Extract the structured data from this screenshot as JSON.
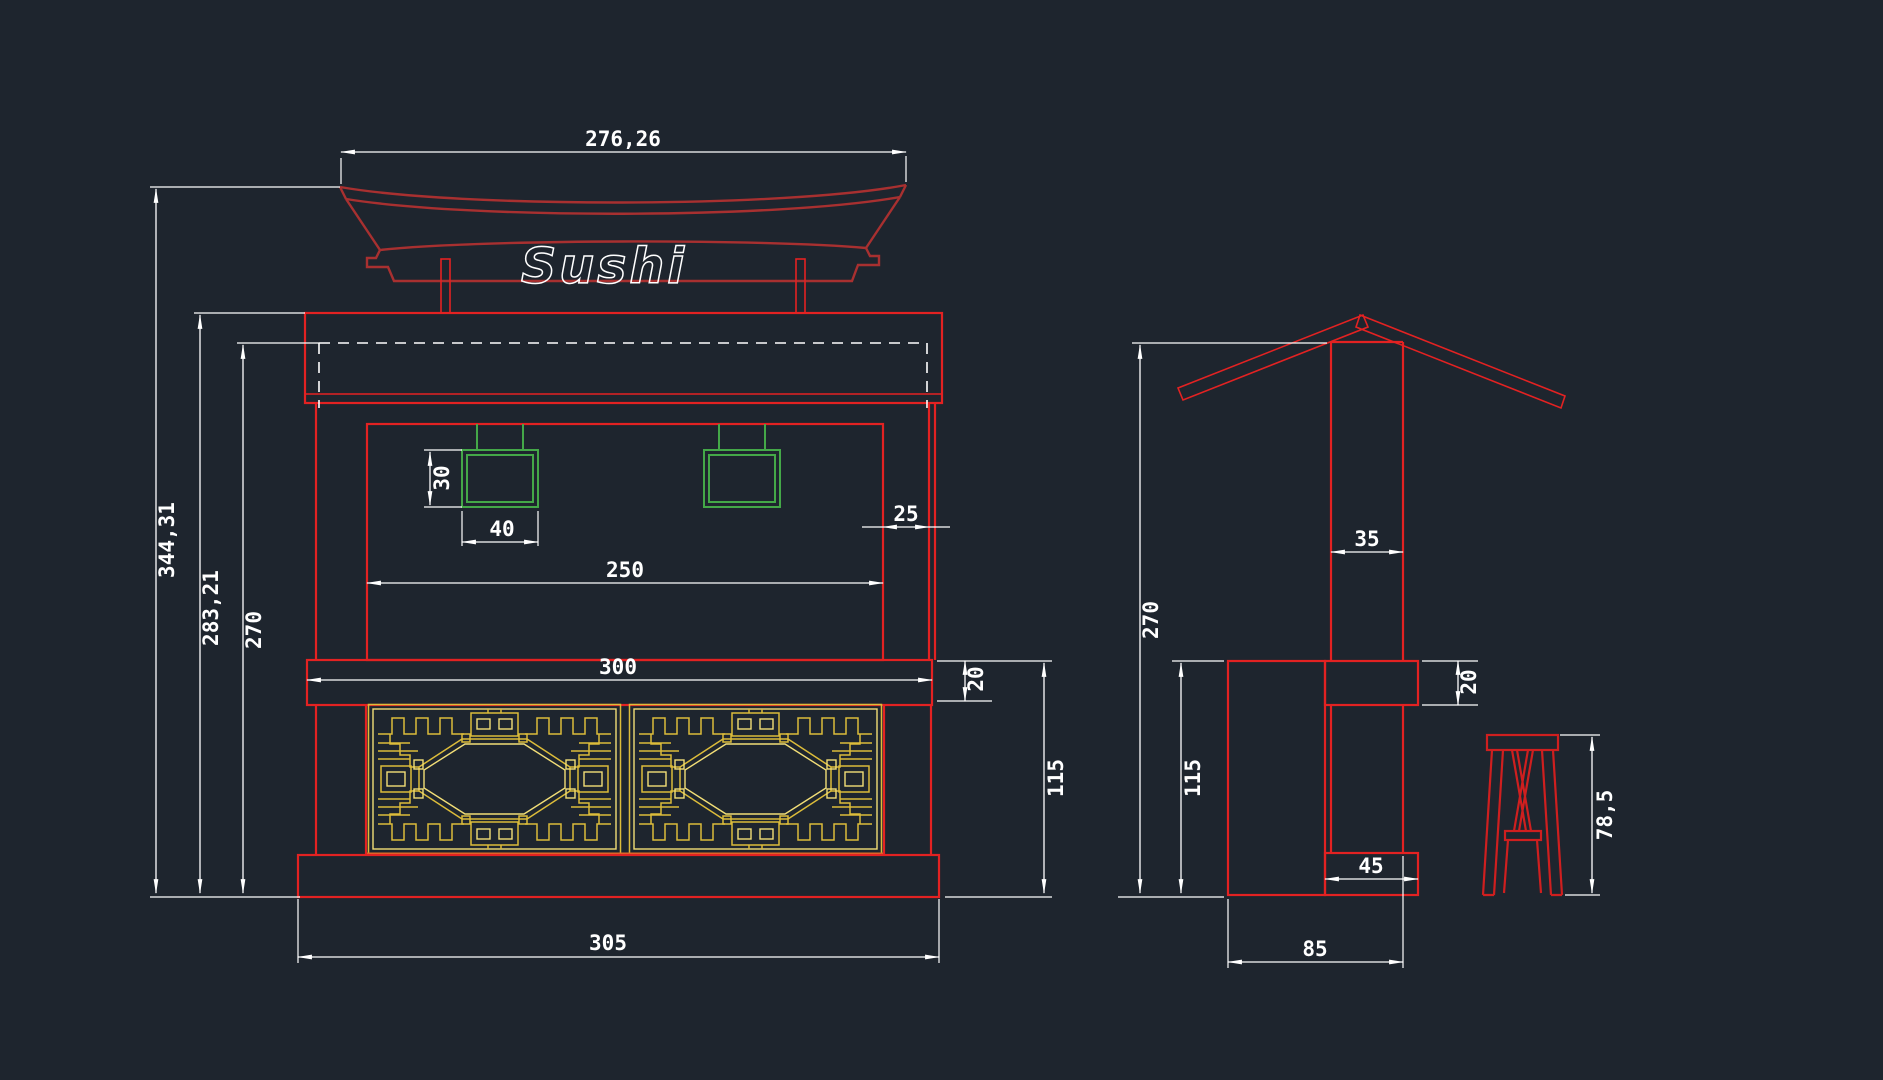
{
  "canvas": {
    "background": "#1e252e"
  },
  "colors": {
    "line_red": "#e32222",
    "roof_red": "#a83030",
    "stool_red": "#cf1f1f",
    "dim_white": "#ffffff",
    "lamp_green": "#44a848",
    "lattice_gold": "#dcbc3a",
    "lattice_accent": "#e06a28"
  },
  "front_view": {
    "sign_text": "Sushi",
    "dims": {
      "roof_width": "276,26",
      "overall_height": "344,31",
      "header_height": "283,21",
      "inner_height": "270",
      "lamp_height": "30",
      "lamp_width": "40",
      "side_offset": "25",
      "opening_width": "250",
      "counter_width": "300",
      "counter_thickness": "20",
      "lower_height": "115",
      "base_width": "305"
    }
  },
  "side_view": {
    "dims": {
      "column_width": "35",
      "overall_height": "270",
      "countertop_thickness": "20",
      "lower_height": "115",
      "foot_width": "45",
      "counter_depth": "85",
      "stool_height": "78,5"
    }
  }
}
